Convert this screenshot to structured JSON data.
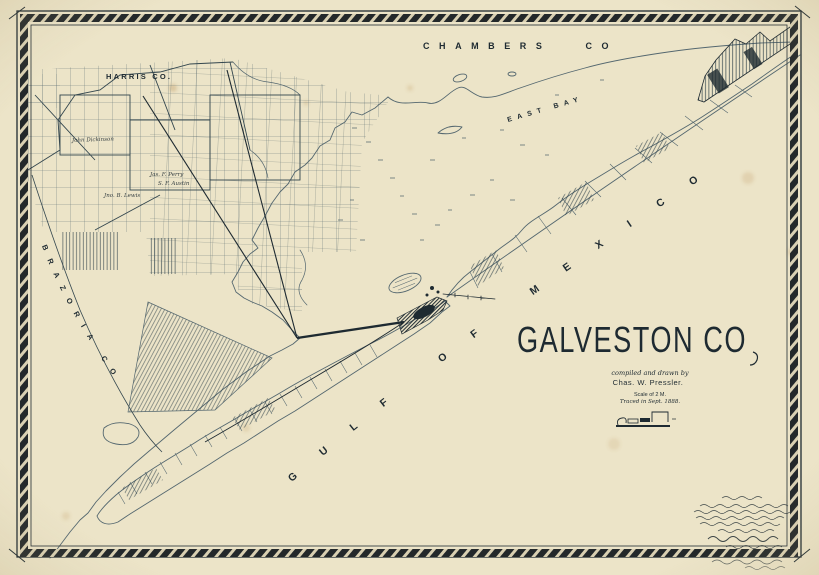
{
  "title_block": {
    "title": "GALVESTON CO",
    "compiled_line": "compiled and drawn by",
    "author_line": "Chas. W. Pressler.",
    "scale_line": "Scale of 2 M.",
    "traced_line": "Traced in Sept. 1888."
  },
  "county_labels": {
    "harris": "HARRIS CO.",
    "chambers": "CHAMBERS CO",
    "brazoria": "BRAZORIA CO"
  },
  "water_labels": {
    "gulf_of_mexico": "GULF OF MEXICO",
    "east_bay": "EAST BAY"
  },
  "parcel_labels": {
    "dickinson": "John Dickinson",
    "lewis": "Jno. B. Lewis",
    "perry": "Jas. F. Perry",
    "austin": "S. F. Austin"
  },
  "colors": {
    "paper": "#ece4c8",
    "ink": "#1e2a31",
    "map_line": "#54676f",
    "stain": "#b98d4f"
  }
}
